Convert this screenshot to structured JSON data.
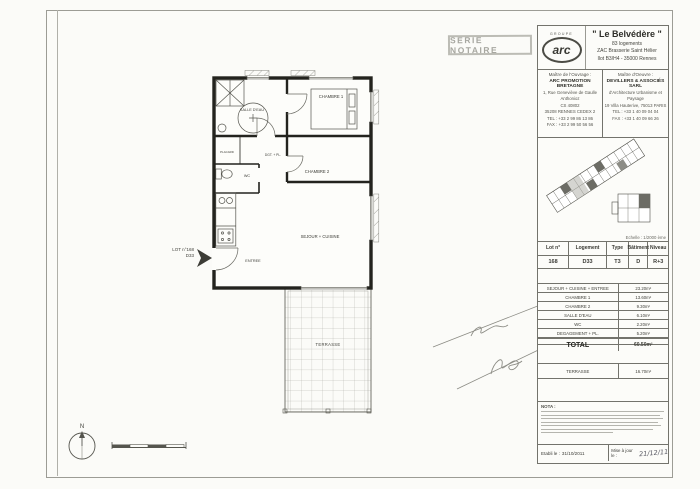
{
  "stamp": {
    "label": "SERIE NOTAIRE"
  },
  "panel": {
    "logo": {
      "group": "GROUPE",
      "name": "arc"
    },
    "project": {
      "title": "\" Le Belvédère \"",
      "subtitle1": "83 logements",
      "subtitle2": "ZAC Brasserie Saint Hélier",
      "subtitle3": "Ilot B3/H4 - 35000 Rennes"
    },
    "owner": {
      "heading": "Maître de l'Ouvrage :",
      "name": "ARC PROMOTION BRETAGNE",
      "lines": [
        "1, Rue Geneviève de Gaulle Anthonioz",
        "CS 40802",
        "35208 RENNES CEDEX 2",
        "TEL : +33 2 99 86 13 86",
        "FAX : +33 2 99 50 56 56"
      ]
    },
    "architect": {
      "heading": "Maître d'Oeuvre :",
      "name": "DEVILLERS & ASSOCIÉS SARL",
      "lines": [
        "d'Architecture Urbanisme et",
        "Paysage",
        "19 Villa Hauterive, 75013 PARIS",
        "TEL : +33 1 40 09 04 04",
        "FAX : +33 1 40 09 66 26"
      ]
    },
    "siteplan_caption": "Echelle : 1/2000 ème",
    "lot_table": {
      "headers": [
        "Lot n°",
        "Logement",
        "Type",
        "Bâtiment",
        "Niveau"
      ],
      "values": [
        "168",
        "D33",
        "T3",
        "D",
        "R+3"
      ]
    },
    "surfaces": {
      "rows": [
        {
          "label": "SEJOUR + CUISINE + ENTREE",
          "value": "23.20m²"
        },
        {
          "label": "CHAMBRE 1",
          "value": "13.60m²"
        },
        {
          "label": "CHAMBRE 2",
          "value": "9.30m²"
        },
        {
          "label": "SALLE D'EAU",
          "value": "6.10m²"
        },
        {
          "label": "WC",
          "value": "2.20m²"
        },
        {
          "label": "DEGAGEMENT + PL.",
          "value": "5.20m²"
        }
      ],
      "total_label": "TOTAL",
      "total_value": "60.50m²"
    },
    "terrace": {
      "label": "TERRASSE",
      "value": "16.70m²"
    },
    "nota_heading": "NOTA :",
    "footer": {
      "etabli_label": "Etabli le :",
      "etabli_value": "31/10/2011",
      "maj_label": "Mise à jour le :",
      "maj_value": "21/12/11"
    }
  },
  "plan": {
    "chambre1": "CHAMBRE 1",
    "chambre2": "CHAMBRE 2",
    "salle_deau": "SALLE D'EAU",
    "wc": "WC",
    "dgt": "DGT. + PL.",
    "placard": "PLACARD",
    "sejour": "SEJOUR + CUISINE",
    "entree": "ENTREE",
    "terrasse": "TERRASSE",
    "lot_line1": "LOT n°168",
    "lot_line2": "D33",
    "north": "N"
  }
}
